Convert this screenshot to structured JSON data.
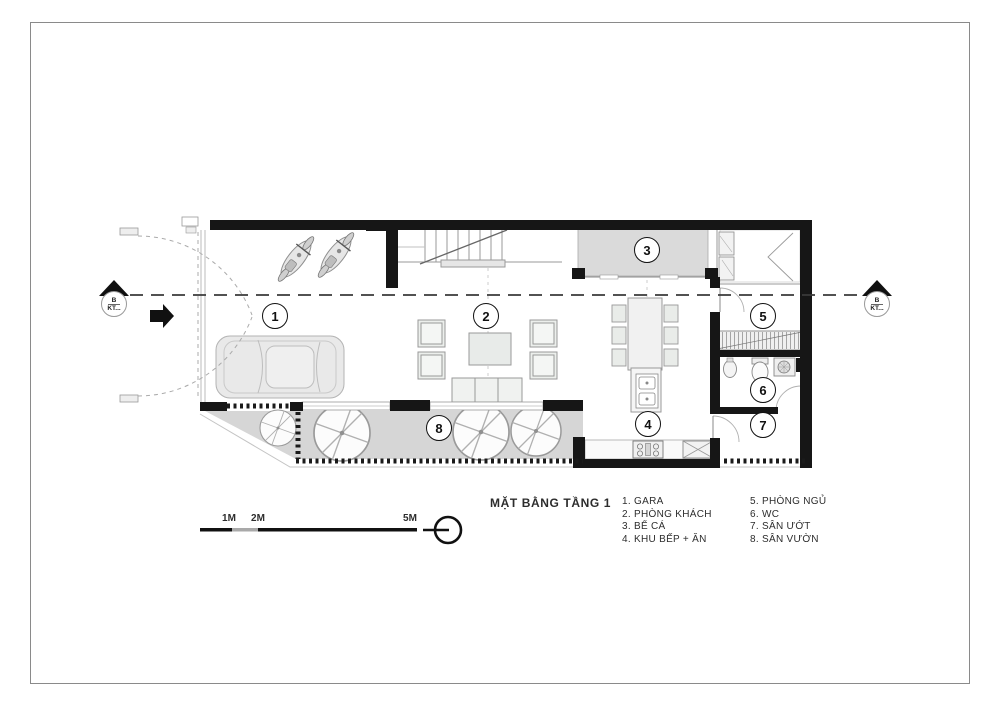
{
  "title": "MẶT BẰNG TẦNG 1",
  "rooms": [
    {
      "number": "1",
      "name": "GARA"
    },
    {
      "number": "2",
      "name": "PHÒNG KHÁCH"
    },
    {
      "number": "3",
      "name": "BỂ CÁ"
    },
    {
      "number": "4",
      "name": "KHU BẾP + ĂN"
    },
    {
      "number": "5",
      "name": "PHÒNG NGỦ"
    },
    {
      "number": "6",
      "name": "WC"
    },
    {
      "number": "7",
      "name": "SÂN ƯỚT"
    },
    {
      "number": "8",
      "name": "SÂN VƯỜN"
    }
  ],
  "legend": {
    "col1": [
      "1. GARA",
      "2. PHÒNG KHÁCH",
      "3. BỂ CÁ",
      "4. KHU BẾP + ĂN"
    ],
    "col2": [
      "5. PHÒNG NGỦ",
      "6. WC",
      "7. SÂN ƯỚT",
      "8. SÂN VƯỜN"
    ]
  },
  "scale_bar": {
    "labels": [
      "1M",
      "2M",
      "5M"
    ]
  },
  "section_markers": {
    "left": {
      "line1": "B",
      "line2": "KT..."
    },
    "right": {
      "line1": "B",
      "line2": "KT..."
    }
  },
  "colors": {
    "wall": "#161616",
    "floor_gray": "#dadada",
    "garden_gray": "#d6d6d6",
    "furniture_line": "#999999",
    "dash_line": "#3a3a3a"
  }
}
